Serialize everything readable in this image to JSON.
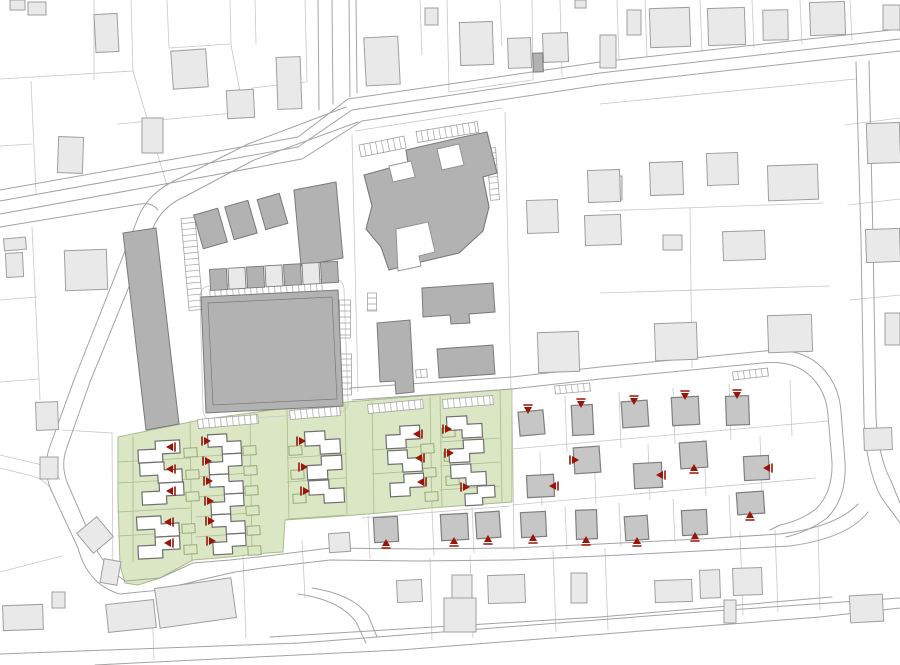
{
  "meta": {
    "title": "Residential development site plan",
    "width": 900,
    "height": 665
  },
  "colors": {
    "bg": "#ffffff",
    "parcel_line": "#c7c7c7",
    "road_line": "#a3a3a3",
    "light_fill": "#e9e9e9",
    "light_stroke": "#9f9f9f",
    "mid_fill": "#b2b2b2",
    "mid_stroke": "#7a7a7a",
    "estate_fill": "#c6c6c6",
    "estate_stroke": "#7f7f7f",
    "green_fill": "#dbe6c4",
    "green_stroke": "#a9bc8c",
    "garage_stroke": "#8fa56e",
    "white_house_fill": "#ffffff",
    "white_house_stroke": "#6f6f6f",
    "marker": "#9b1408",
    "courtyard_fill": "#ffffff",
    "courtyard_stroke": "#909090"
  },
  "green_zones": [
    [
      [
        118,
        437
      ],
      [
        200,
        420
      ],
      [
        300,
        406
      ],
      [
        420,
        396
      ],
      [
        512,
        389
      ],
      [
        512,
        502
      ],
      [
        430,
        508
      ],
      [
        380,
        513
      ],
      [
        330,
        517
      ],
      [
        285,
        520
      ],
      [
        283,
        552
      ],
      [
        267,
        553
      ],
      [
        230,
        557
      ],
      [
        193,
        560
      ],
      [
        160,
        578
      ],
      [
        138,
        585
      ],
      [
        125,
        583
      ],
      [
        120,
        565
      ],
      [
        118,
        500
      ]
    ]
  ],
  "green_lines": [
    "M190,421 L192,561",
    "M250,414 L252,554",
    "M287,410 L289,519",
    "M345,404 L347,515",
    "M372,402 L374,513",
    "M430,397 L432,508",
    "M440,396 L442,507",
    "M500,391 L502,502",
    "M118,462 L190,458",
    "M118,483 L190,479",
    "M118,512 L190,508",
    "M118,536 L190,532",
    "M196,457 L250,453",
    "M196,477 L250,473",
    "M196,497 L250,493",
    "M196,517 L250,513",
    "M196,537 L250,533",
    "M287,458 L345,454",
    "M287,482 L345,478",
    "M287,519 L345,515",
    "M372,450 L430,446",
    "M372,474 L430,470",
    "M440,442 L500,438",
    "M440,466 L500,462",
    "M440,490 L500,486",
    "M133,437 L133,562"
  ],
  "parcel_paths": [
    "M0,79 L133,71",
    "M94,0 L94,80",
    "M131,0 L133,71",
    "M133,71 L167,186",
    "M31,81 L36,193",
    "M0,146 L32,144",
    "M167,0 L169,48",
    "M169,48 L230,44",
    "M230,0 L231,45",
    "M231,45 L244,112",
    "M118,124 L244,112",
    "M244,112 L252,88 L305,82",
    "M305,0 L307,82",
    "M255,0 L256,44",
    "M420,0 L422,55",
    "M447,0 L449,92",
    "M449,92 L532,80",
    "M500,0 L502,46",
    "M532,0 L533,80",
    "M560,0 L562,76",
    "M617,0 L619,60",
    "M645,0 L647,57",
    "M700,0 L702,52",
    "M752,0 L754,48",
    "M800,0 L802,44",
    "M850,0 L852,40",
    "M600,104 L856,79",
    "M690,208 L692,368",
    "M600,211 L823,203",
    "M600,293 L830,286",
    "M845,125 L900,118",
    "M848,205 L900,199",
    "M850,300 L900,295",
    "M32,227 L40,400",
    "M0,300 L37,297",
    "M0,382 L39,379",
    "M112,432 L113,582",
    "M62,430 L112,433",
    "M512,390 L514,550",
    "M565,396 L567,452",
    "M619,392 L621,448",
    "M673,388 L675,444",
    "M729,384 L731,440",
    "M790,380 L792,436",
    "M512,449 L828,421",
    "M512,505 L816,478",
    "M565,507 L567,549",
    "M619,503 L621,546",
    "M673,499 L675,542",
    "M729,495 L731,537",
    "M540,452 L542,506",
    "M594,448 L596,503",
    "M648,444 L650,500",
    "M704,440 L706,496",
    "M760,436 L762,492",
    "M368,516 L370,559",
    "M432,510 L434,556",
    "M472,507 L474,553",
    "M362,518 L510,506",
    "M152,600 L154,660",
    "M243,556 L246,638",
    "M302,540 L305,598",
    "M430,558 L432,640",
    "M470,556 L473,638",
    "M553,550 L556,632",
    "M605,548 L608,630",
    "M740,532 L743,615",
    "M775,530 L778,612",
    "M818,527 L820,610",
    "M200,297 Q200,287 210,286 L332,279 Q343,278 344,289 L348,400 Q349,412 337,413 L215,420 Q204,421 203,410 Z",
    "M355,131 L502,108",
    "M505,112 L511,390",
    "M352,135 L358,392",
    "M0,455 L38,464 Q54,468 60,480",
    "M0,468 L32,476 Q46,480 52,491",
    "M62,556 L0,572"
  ],
  "road_paths": [
    "M0,201 L298,147 L352,110 L600,73 L900,39",
    "M0,214 L302,159 L362,121 L600,85 L900,51",
    "M0,190 L298,137 L348,99 L600,62 L900,29",
    "M0,227 L140,204 Q152,202 158,210",
    "M332,0 L333,104",
    "M349,0 L350,97",
    "M318,0 L319,110",
    "M356,0 L357,93",
    "M346,107 L248,144 L180,178 Q148,192 138,218 L74,380 L50,446 Q42,468 51,490 L78,548 Q88,585 120,594 L160,590 L200,580 L235,572 L270,567 L330,560 L420,561 L512,560 L600,556 L700,551 L790,546 Q848,538 868,512",
    "M358,122 L254,160 L186,196 Q162,206 153,228 L90,382 L66,450 Q61,466 67,482 L92,540 Q102,565 125,581 L160,578 L193,563 L230,560 L267,556 L330,548 L420,549 L512,548 L600,544 L700,539 L780,534 Q836,527 858,504",
    "M350,388 L512,377 L600,367 L764,351 Q798,347 818,364 Q839,382 841,412 L845,462 Q847,498 827,518 Q808,532 786,537",
    "M352,400 L512,389 L600,379 L762,363 Q792,360 808,374 Q826,389 828,415 L832,462 Q833,492 816,509 Q800,521 780,525 L770,530",
    "M856,62 L861,240 L864,420 Q866,468 881,497 L900,523",
    "M869,61 L873,240 L876,417 Q878,456 891,481 L900,503",
    "M0,654 L300,643 L700,612 L900,598",
    "M95,665 L400,650 L820,617 L900,608",
    "M270,637 L600,617 L832,597",
    "M298,594 Q340,600 356,622 L366,643",
    "M312,588 Q352,594 368,615 L377,637"
  ],
  "school": {
    "hull": [
      [
        364,
        175
      ],
      [
        408,
        163
      ],
      [
        406,
        150
      ],
      [
        458,
        138
      ],
      [
        487,
        132
      ],
      [
        497,
        173
      ],
      [
        483,
        177
      ],
      [
        489,
        207
      ],
      [
        483,
        231
      ],
      [
        459,
        253
      ],
      [
        421,
        262
      ],
      [
        389,
        270
      ],
      [
        381,
        247
      ],
      [
        366,
        229
      ],
      [
        372,
        206
      ]
    ],
    "courtyards": [
      [
        [
          389,
          166
        ],
        [
          411,
          161
        ],
        [
          415,
          177
        ],
        [
          393,
          182
        ]
      ],
      [
        [
          437,
          149
        ],
        [
          459,
          144
        ],
        [
          464,
          165
        ],
        [
          442,
          170
        ]
      ],
      [
        [
          396,
          229
        ],
        [
          428,
          222
        ],
        [
          435,
          252
        ],
        [
          419,
          256
        ],
        [
          421,
          266
        ],
        [
          398,
          271
        ]
      ]
    ]
  },
  "mid_polygons": [
    [
      [
        123,
        233
      ],
      [
        156,
        228
      ],
      [
        179,
        424
      ],
      [
        146,
        430
      ]
    ],
    [
      [
        201,
        297
      ],
      [
        338,
        290
      ],
      [
        343,
        406
      ],
      [
        206,
        413
      ]
    ],
    [
      [
        294,
        190
      ],
      [
        336,
        182
      ],
      [
        343,
        258
      ],
      [
        301,
        266
      ]
    ],
    [
      [
        422,
        288
      ],
      [
        493,
        283
      ],
      [
        495,
        312
      ],
      [
        469,
        314
      ],
      [
        470,
        323
      ],
      [
        451,
        324
      ],
      [
        450,
        315
      ],
      [
        423,
        317
      ]
    ],
    [
      [
        377,
        323
      ],
      [
        410,
        320
      ],
      [
        414,
        392
      ],
      [
        396,
        394
      ],
      [
        395,
        381
      ],
      [
        380,
        382
      ]
    ]
  ],
  "plaza_inner": [
    [
      208,
      303
    ],
    [
      332,
      297
    ],
    [
      337,
      399
    ],
    [
      213,
      405
    ]
  ],
  "mid_rects": [
    [
      198,
      211,
      25,
      35,
      -16
    ],
    [
      229,
      203,
      24,
      34,
      -16
    ],
    [
      261,
      196,
      23,
      31,
      -16
    ],
    [
      438,
      347,
      56,
      29,
      -4
    ],
    [
      533,
      53,
      10,
      19,
      -2
    ]
  ],
  "carport_row": {
    "x": 210,
    "y": 269,
    "step": 18.5,
    "count": 7,
    "w": 17,
    "h": 21,
    "tilt": -3,
    "drop": -1.2
  },
  "ladders": [
    {
      "x1": 188,
      "y1": 218,
      "x2": 196,
      "y2": 310,
      "w": 14
    },
    {
      "x1": 360,
      "y1": 151,
      "x2": 405,
      "y2": 142,
      "w": 12
    },
    {
      "x1": 417,
      "y1": 137,
      "x2": 478,
      "y2": 127,
      "w": 11
    },
    {
      "x1": 491,
      "y1": 148,
      "x2": 495,
      "y2": 200,
      "w": 9
    },
    {
      "x1": 372,
      "y1": 293,
      "x2": 372,
      "y2": 311,
      "w": 9
    },
    {
      "x1": 416,
      "y1": 374,
      "x2": 427,
      "y2": 373,
      "w": 8
    },
    {
      "x1": 345,
      "y1": 300,
      "x2": 345,
      "y2": 338,
      "w": 11
    },
    {
      "x1": 346,
      "y1": 354,
      "x2": 346,
      "y2": 395,
      "w": 11
    },
    {
      "x1": 210,
      "y1": 294,
      "x2": 322,
      "y2": 287,
      "w": 8
    }
  ],
  "tick_strips": [
    {
      "x1": 198,
      "y1": 424,
      "x2": 258,
      "y2": 419,
      "w": 9
    },
    {
      "x1": 290,
      "y1": 415,
      "x2": 340,
      "y2": 411,
      "w": 9
    },
    {
      "x1": 368,
      "y1": 409,
      "x2": 423,
      "y2": 404,
      "w": 9
    },
    {
      "x1": 443,
      "y1": 404,
      "x2": 493,
      "y2": 400,
      "w": 9
    },
    {
      "x1": 733,
      "y1": 376,
      "x2": 768,
      "y2": 372,
      "w": 8
    },
    {
      "x1": 555,
      "y1": 390,
      "x2": 590,
      "y2": 387,
      "w": 8
    }
  ],
  "light_buildings": [
    [
      95,
      14,
      23,
      38,
      -3
    ],
    [
      10,
      0,
      15,
      10,
      0
    ],
    [
      28,
      2,
      18,
      13,
      0
    ],
    [
      172,
      50,
      35,
      38,
      -4
    ],
    [
      142,
      118,
      21,
      35,
      0
    ],
    [
      58,
      137,
      25,
      36,
      2
    ],
    [
      227,
      90,
      27,
      28,
      -3
    ],
    [
      277,
      57,
      24,
      52,
      -2
    ],
    [
      365,
      37,
      34,
      48,
      -3
    ],
    [
      425,
      8,
      13,
      17,
      0
    ],
    [
      460,
      22,
      33,
      43,
      -2
    ],
    [
      508,
      38,
      23,
      30,
      -2
    ],
    [
      543,
      33,
      25,
      29,
      -2
    ],
    [
      575,
      0,
      11,
      8,
      0
    ],
    [
      627,
      10,
      14,
      25,
      0
    ],
    [
      650,
      8,
      40,
      39,
      -2
    ],
    [
      708,
      8,
      37,
      37,
      -2
    ],
    [
      763,
      10,
      25,
      30,
      -1
    ],
    [
      810,
      2,
      35,
      33,
      -2
    ],
    [
      883,
      5,
      17,
      25,
      0
    ],
    [
      600,
      35,
      16,
      33,
      0
    ],
    [
      867,
      123,
      33,
      40,
      -2
    ],
    [
      600,
      176,
      22,
      24,
      0
    ],
    [
      650,
      162,
      33,
      33,
      -2
    ],
    [
      707,
      153,
      31,
      32,
      -2
    ],
    [
      768,
      165,
      50,
      35,
      -2
    ],
    [
      527,
      200,
      31,
      33,
      -2
    ],
    [
      588,
      170,
      32,
      32,
      -2
    ],
    [
      585,
      215,
      36,
      30,
      -2
    ],
    [
      723,
      231,
      42,
      29,
      -2
    ],
    [
      866,
      229,
      34,
      33,
      -2
    ],
    [
      663,
      235,
      19,
      15,
      0
    ],
    [
      538,
      332,
      41,
      40,
      -2
    ],
    [
      655,
      323,
      42,
      37,
      -2
    ],
    [
      768,
      315,
      44,
      37,
      -2
    ],
    [
      885,
      313,
      15,
      32,
      0
    ],
    [
      65,
      250,
      42,
      40,
      -2
    ],
    [
      4,
      238,
      22,
      12,
      -5
    ],
    [
      6,
      253,
      17,
      24,
      -3
    ],
    [
      36,
      402,
      22,
      28,
      -2
    ],
    [
      40,
      457,
      18,
      22,
      0
    ],
    [
      82,
      522,
      26,
      26,
      -40
    ],
    [
      3,
      605,
      40,
      25,
      -2
    ],
    [
      52,
      592,
      13,
      16,
      0
    ],
    [
      107,
      602,
      48,
      28,
      -6
    ],
    [
      157,
      583,
      77,
      40,
      -8
    ],
    [
      102,
      560,
      17,
      24,
      10
    ],
    [
      397,
      580,
      25,
      22,
      -3
    ],
    [
      452,
      575,
      20,
      24,
      0
    ],
    [
      444,
      598,
      32,
      34,
      0
    ],
    [
      488,
      575,
      37,
      28,
      -2
    ],
    [
      571,
      573,
      16,
      30,
      0
    ],
    [
      655,
      580,
      37,
      22,
      -2
    ],
    [
      700,
      570,
      20,
      28,
      -2
    ],
    [
      733,
      568,
      29,
      27,
      -2
    ],
    [
      724,
      600,
      12,
      23,
      0
    ],
    [
      850,
      595,
      33,
      27,
      -3
    ],
    [
      864,
      428,
      28,
      22,
      -2
    ],
    [
      329,
      533,
      21,
      19,
      -4
    ]
  ],
  "white_houses": [
    [
      138,
      441,
      42,
      21
    ],
    [
      140,
      462,
      42,
      21
    ],
    [
      142,
      483,
      42,
      21
    ],
    [
      137,
      516,
      42,
      21
    ],
    [
      138,
      537,
      42,
      21
    ],
    [
      208,
      434,
      33,
      20
    ],
    [
      209,
      454,
      33,
      20
    ],
    [
      210,
      474,
      33,
      20
    ],
    [
      211,
      494,
      33,
      20
    ],
    [
      212,
      514,
      33,
      20
    ],
    [
      213,
      534,
      33,
      20
    ],
    [
      305,
      431,
      35,
      23
    ],
    [
      307,
      456,
      35,
      23
    ],
    [
      309,
      480,
      35,
      23
    ],
    [
      386,
      426,
      34,
      22
    ],
    [
      388,
      450,
      34,
      22
    ],
    [
      390,
      474,
      34,
      22
    ],
    [
      447,
      416,
      35,
      22
    ],
    [
      449,
      440,
      35,
      22
    ],
    [
      451,
      464,
      35,
      22
    ],
    [
      465,
      486,
      30,
      19
    ]
  ],
  "garages": [
    [
      184,
      448
    ],
    [
      186,
      470
    ],
    [
      186,
      492
    ],
    [
      182,
      524
    ],
    [
      184,
      545
    ],
    [
      243,
      446
    ],
    [
      244,
      466
    ],
    [
      245,
      486
    ],
    [
      246,
      506
    ],
    [
      247,
      526
    ],
    [
      248,
      546
    ],
    [
      289,
      446
    ],
    [
      291,
      470
    ],
    [
      293,
      494
    ],
    [
      421,
      444
    ],
    [
      423,
      468
    ],
    [
      425,
      492
    ],
    [
      442,
      428
    ],
    [
      444,
      452
    ],
    [
      446,
      476
    ]
  ],
  "estate_houses": [
    [
      519,
      411,
      25,
      24,
      -5
    ],
    [
      572,
      405,
      21,
      30,
      -3
    ],
    [
      622,
      401,
      26,
      26,
      -4
    ],
    [
      672,
      397,
      27,
      28,
      -3
    ],
    [
      726,
      396,
      23,
      29,
      -2
    ],
    [
      527,
      475,
      27,
      22,
      -3
    ],
    [
      574,
      447,
      26,
      26,
      -4
    ],
    [
      634,
      463,
      28,
      25,
      -3
    ],
    [
      680,
      442,
      27,
      26,
      -4
    ],
    [
      744,
      456,
      25,
      24,
      -3
    ],
    [
      521,
      512,
      25,
      25,
      -3
    ],
    [
      576,
      510,
      21,
      29,
      -2
    ],
    [
      625,
      516,
      23,
      24,
      -4
    ],
    [
      682,
      510,
      25,
      25,
      -3
    ],
    [
      737,
      492,
      27,
      22,
      -4
    ],
    [
      374,
      517,
      24,
      25,
      -3
    ],
    [
      441,
      514,
      27,
      26,
      -3
    ],
    [
      476,
      512,
      24,
      26,
      -4
    ]
  ],
  "markers": [
    [
      173,
      447,
      "left"
    ],
    [
      173,
      469,
      "left"
    ],
    [
      173,
      491,
      "left"
    ],
    [
      171,
      522,
      "left"
    ],
    [
      171,
      543,
      "left"
    ],
    [
      204,
      441,
      "right"
    ],
    [
      205,
      461,
      "right"
    ],
    [
      206,
      481,
      "right"
    ],
    [
      207,
      501,
      "right"
    ],
    [
      208,
      521,
      "right"
    ],
    [
      209,
      541,
      "right"
    ],
    [
      299,
      441,
      "right"
    ],
    [
      301,
      467,
      "right"
    ],
    [
      303,
      491,
      "right"
    ],
    [
      420,
      434,
      "left"
    ],
    [
      422,
      458,
      "left"
    ],
    [
      424,
      482,
      "left"
    ],
    [
      445,
      429,
      "right"
    ],
    [
      447,
      453,
      "right"
    ],
    [
      463,
      487,
      "right"
    ],
    [
      528,
      407,
      "down"
    ],
    [
      581,
      401,
      "down"
    ],
    [
      634,
      398,
      "down"
    ],
    [
      685,
      393,
      "down"
    ],
    [
      737,
      392,
      "down"
    ],
    [
      556,
      486,
      "left"
    ],
    [
      572,
      460,
      "right"
    ],
    [
      663,
      475,
      "left"
    ],
    [
      694,
      471,
      "up"
    ],
    [
      770,
      468,
      "left"
    ],
    [
      533,
      541,
      "up"
    ],
    [
      586,
      543,
      "up"
    ],
    [
      637,
      544,
      "up"
    ],
    [
      695,
      539,
      "up"
    ],
    [
      750,
      518,
      "up"
    ],
    [
      386,
      546,
      "up"
    ],
    [
      454,
      544,
      "up"
    ],
    [
      488,
      542,
      "up"
    ]
  ]
}
